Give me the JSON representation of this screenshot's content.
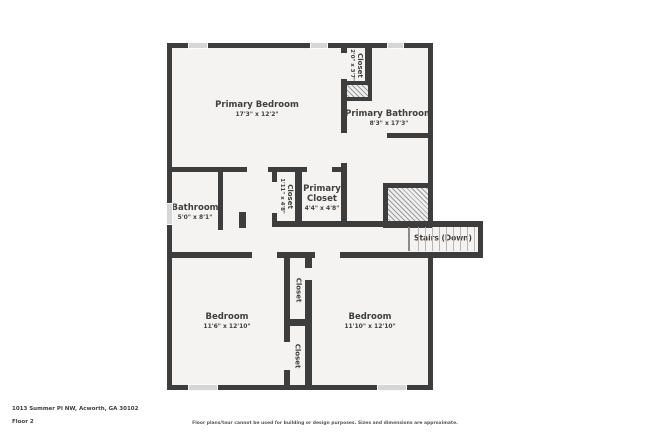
{
  "floorplan": {
    "rooms": {
      "primary_bedroom": {
        "name": "Primary Bedroom",
        "dims": "17'3\" x 12'2\""
      },
      "top_closet": {
        "name": "Closet",
        "dims": "2'0\" x 3'7\""
      },
      "primary_bathroom": {
        "name": "Primary Bathroom",
        "dims": "8'3\" x 17'3\""
      },
      "bathroom": {
        "name": "Bathroom",
        "dims": "5'0\" x 8'1\""
      },
      "hall_closet": {
        "name": "Closet",
        "dims": "1'11\" x 4'8\""
      },
      "primary_closet": {
        "name": "Primary Closet",
        "dims": "4'4\" x 4'8\""
      },
      "stairs": {
        "name": "Stairs (Down)"
      },
      "bedroom_left": {
        "name": "Bedroom",
        "dims": "11'6\" x 12'10\""
      },
      "closet_upper": {
        "name": "Closet"
      },
      "closet_lower": {
        "name": "Closet"
      },
      "bedroom_right": {
        "name": "Bedroom",
        "dims": "11'10\" x 12'10\""
      }
    },
    "colors": {
      "wall": "#3d3d3d",
      "floor": "#f4f3f1",
      "hatch_line": "#9b9b9b",
      "window": "#d6d6d6",
      "label_text": "#3f3f3f"
    }
  },
  "footer": {
    "address": "1013 Summer Pl NW, Acworth, GA 30102",
    "floor_label": "Floor 2",
    "disclaimer": "Floor plans/tour cannot be used for building or design purposes. Sizes and dimensions are approximate."
  }
}
